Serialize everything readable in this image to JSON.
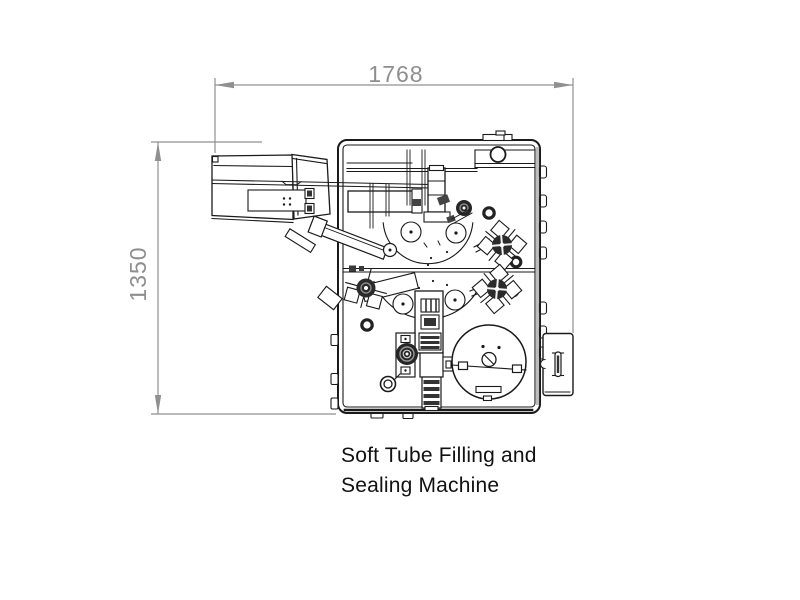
{
  "diagram": {
    "type": "engineering-drawing-top-view",
    "machine_name": "Soft Tube Filling and Sealing Machine",
    "caption": {
      "line1": "Soft Tube Filling and",
      "line2": "Sealing Machine"
    },
    "dimensions": {
      "width_label": "1768",
      "height_label": "1350"
    },
    "colors": {
      "background": "#ffffff",
      "dimension_lines": "#909090",
      "dimension_text": "#8e8e8e",
      "drawing_lines": "#1a1a1a",
      "caption_text": "#111111"
    }
  }
}
